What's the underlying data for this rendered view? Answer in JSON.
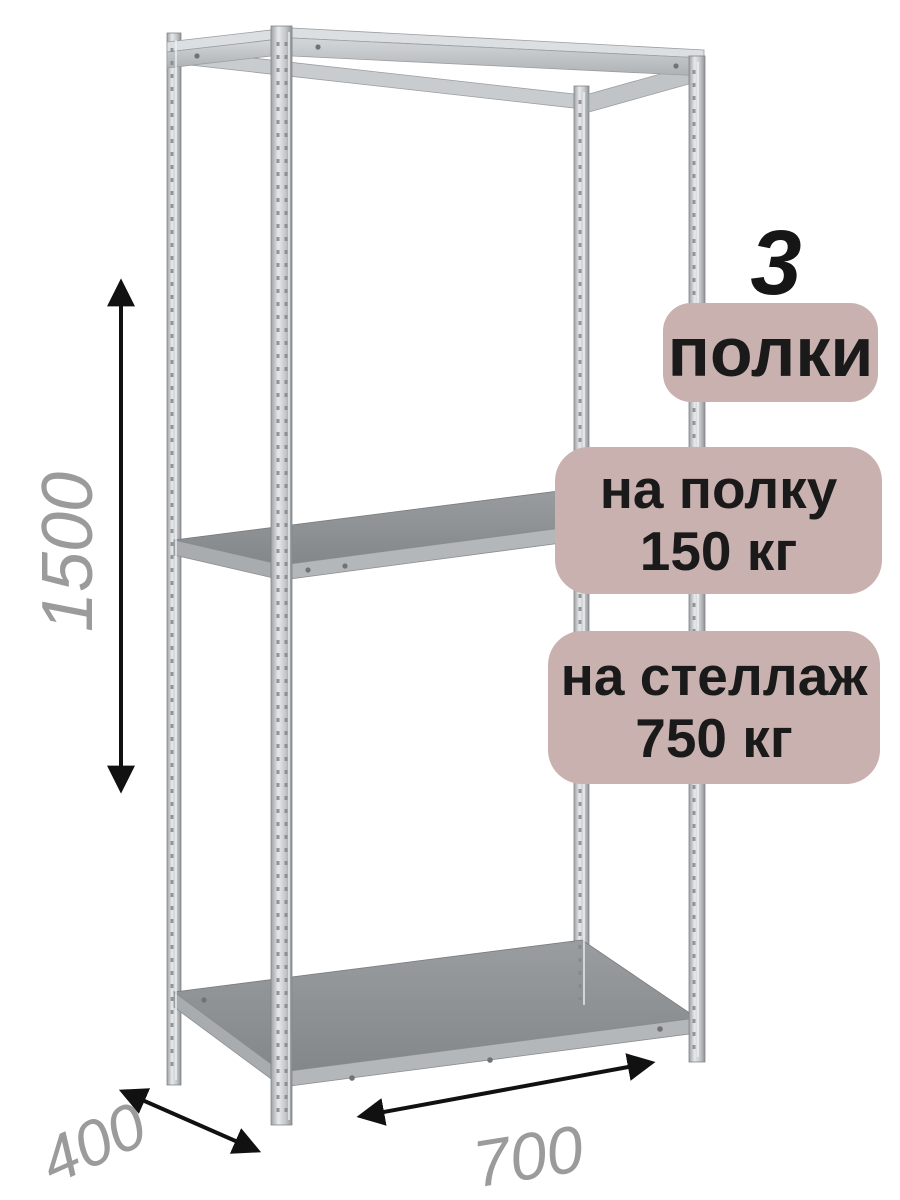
{
  "badges": {
    "shelves": {
      "number": "3",
      "label": "полки"
    },
    "per_shelf": {
      "line1": "на полку",
      "line2": "150 кг"
    },
    "per_rack": {
      "line1": "на стеллаж",
      "line2": "750 кг"
    }
  },
  "dimensions": {
    "height_mm": "1500",
    "depth_mm": "400",
    "width_mm": "700"
  },
  "colors": {
    "badge_background": "#c9b1b0",
    "badge_text": "#1a1a1a",
    "dimension_text": "#9b9b9b",
    "arrow": "#111111",
    "metal_light": "#e6e8ea",
    "metal_mid": "#bfc3c6",
    "metal_dark": "#8c9093",
    "background": "#ffffff"
  }
}
